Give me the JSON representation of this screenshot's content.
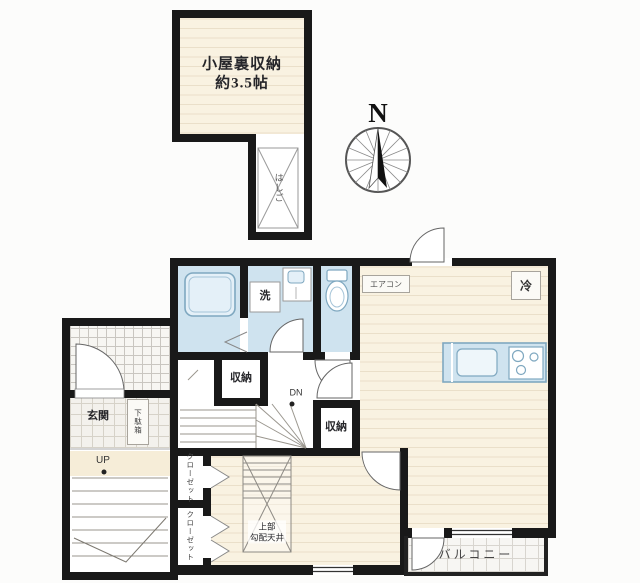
{
  "labels": {
    "attic_name": "小屋裏収納",
    "attic_size": "約3.5帖",
    "attic_ladder_shaft": "はしご",
    "north": "N",
    "washer": "洗",
    "aircon": "エアコン",
    "fridge": "冷",
    "storage_hall": "収納",
    "storage_bedroom": "収納",
    "stairs_down": "DN",
    "entrance": "玄関",
    "shoe_cabinet": "下駄箱",
    "stairs_up": "UP",
    "closet_upper": "クローゼット",
    "closet_lower": "クローゼット",
    "ladder_note_line1": "上部",
    "ladder_note_line2": "勾配天井",
    "balcony": "バルコニー"
  },
  "colors": {
    "wall": "#191919",
    "wet_area_floor": "#cfe3ef",
    "wood_floor": "#f9f2e1",
    "wood_floor_line": "#eadfc9",
    "fixture_outline": "#7fa8c0",
    "tile_line": "#d6d2c8",
    "text": "#26262a"
  }
}
